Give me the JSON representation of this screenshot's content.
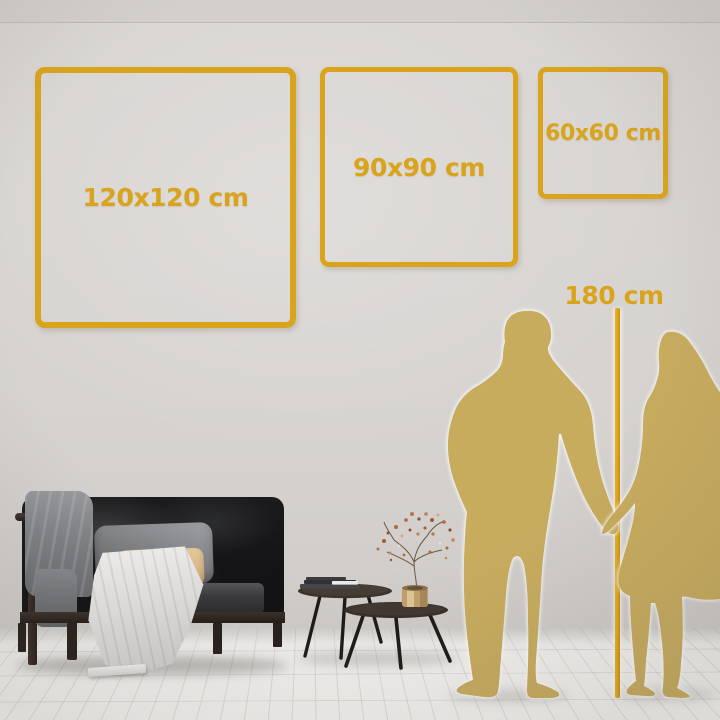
{
  "title": "Wall art size comparison guide",
  "frames": [
    {
      "id": "size-120",
      "label": "120x120 cm"
    },
    {
      "id": "size-90",
      "label": "90x90 cm"
    },
    {
      "id": "size-60",
      "label": "60x60 cm"
    }
  ],
  "height_marker": {
    "label": "180 cm"
  },
  "palette": {
    "accent_gold": "#D9A41C",
    "marker_line_gold": "#E0A714",
    "silhouette_gold": "#C8AC5E",
    "wall_gray": "#D6D3D0",
    "floor_white": "#F2F1EF"
  },
  "scene_objects": [
    "dark-sofa-with-pillows",
    "gray-throw-blanket",
    "white-draped-blanket",
    "nesting-coffee-tables",
    "stacked-books",
    "brass-vase-with-dried-branch",
    "man-silhouette",
    "woman-silhouette"
  ]
}
